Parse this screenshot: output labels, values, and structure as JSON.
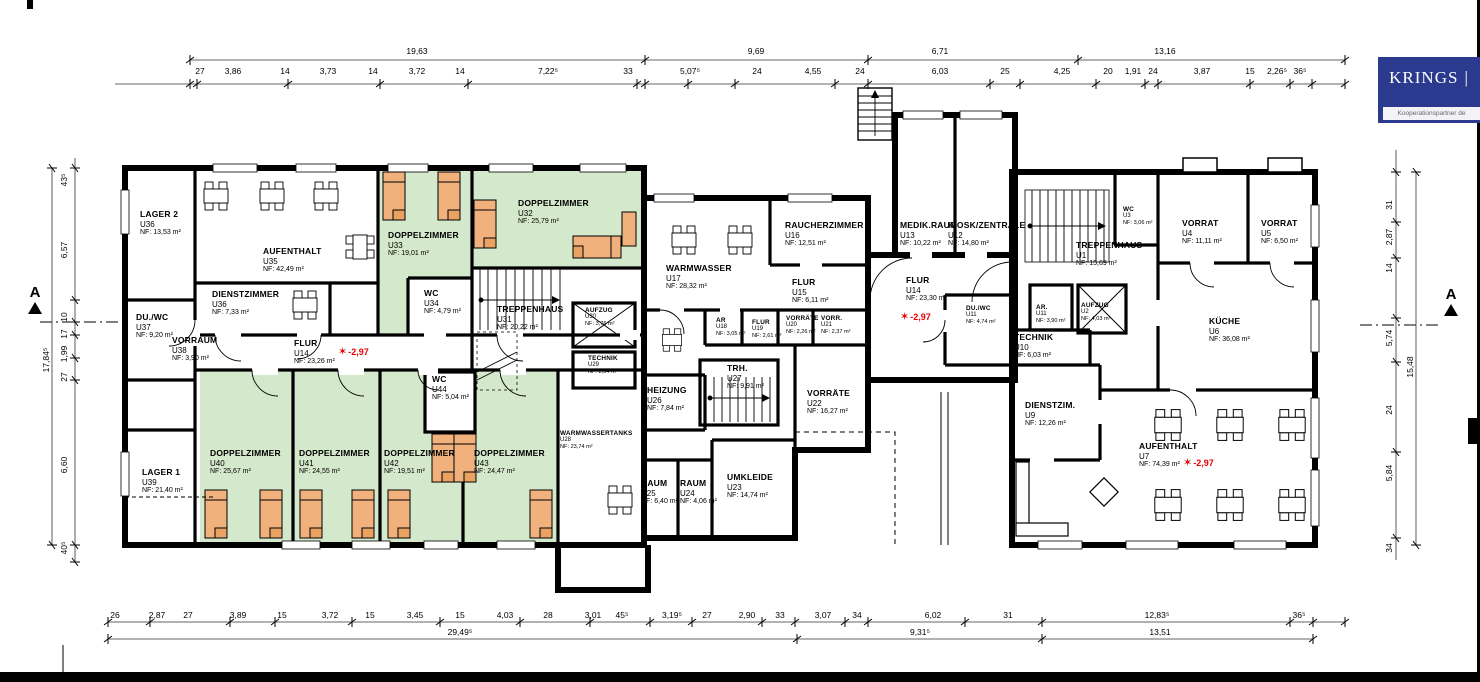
{
  "logo": {
    "brand": "KRINGS",
    "separator": "|",
    "subtitle": "Kooperationspartner de"
  },
  "section_marker": {
    "label": "A"
  },
  "icons": {
    "level_marker": "✶"
  },
  "levels": [
    "-2,97",
    "-2,97",
    "-2,97"
  ],
  "rooms": [
    {
      "name": "LAGER 2",
      "unit": "U36",
      "nf": "NF: 13,53 m²"
    },
    {
      "name": "AUFENTHALT",
      "unit": "U35",
      "nf": "NF:   42,49 m²"
    },
    {
      "name": "DIENSTZIMMER",
      "unit": "U36",
      "nf": "NF:   7,33 m²"
    },
    {
      "name": "DU./WC",
      "unit": "U37",
      "nf": "NF: 9,20 m²"
    },
    {
      "name": "VORRAUM",
      "unit": "U38",
      "nf": "NF:   3,90 m²"
    },
    {
      "name": "FLUR",
      "unit": "U14",
      "nf": "NF: 23,26 m²"
    },
    {
      "name": "DOPPELZIMMER",
      "unit": "U33",
      "nf": "NF:   19,01 m²"
    },
    {
      "name": "WC",
      "unit": "U34",
      "nf": "NF: 4,79 m²"
    },
    {
      "name": "DOPPELZIMMER",
      "unit": "U32",
      "nf": "NF:   25,79 m²"
    },
    {
      "name": "TREPPENHAUS",
      "unit": "U31",
      "nf": "NF:   20,22 m²"
    },
    {
      "name": "AUFZUG",
      "unit": "U30",
      "nf": "NF: 3,76 m²"
    },
    {
      "name": "TECHNIK",
      "unit": "U29",
      "nf": "NF: 2,34 m²"
    },
    {
      "name": "LAGER 1",
      "unit": "U39",
      "nf": "NF: 21,40 m²"
    },
    {
      "name": "DOPPELZIMMER",
      "unit": "U40",
      "nf": "NF:   25,67 m²"
    },
    {
      "name": "DOPPELZIMMER",
      "unit": "U41",
      "nf": "NF:   24,55 m²"
    },
    {
      "name": "DOPPELZIMMER",
      "unit": "U42",
      "nf": "NF:   19,51 m²"
    },
    {
      "name": "DOPPELZIMMER",
      "unit": "U43",
      "nf": "NF:   24,47 m²"
    },
    {
      "name": "WC",
      "unit": "U44",
      "nf": "NF: 5,04 m²"
    },
    {
      "name": "WARMWASSERTANKS",
      "unit": "U28",
      "nf": "NF:   23,74 m²"
    },
    {
      "name": "WARMWASSER",
      "unit": "U17",
      "nf": "NF:   28,32 m²"
    },
    {
      "name": "RAUCHERZIMMER",
      "unit": "U16",
      "nf": "NF:   12,51 m²"
    },
    {
      "name": "FLUR",
      "unit": "U15",
      "nf": "NF: 6,11 m²"
    },
    {
      "name": "AR",
      "unit": "U18",
      "nf": "NF: 3,05 m²"
    },
    {
      "name": "FLUR",
      "unit": "U19",
      "nf": "NF: 2,61 m²"
    },
    {
      "name": "VORRÄTE",
      "unit": "U20",
      "nf": "NF: 2,26 m²"
    },
    {
      "name": "VORR.",
      "unit": "U21",
      "nf": "NF: 2,37 m²"
    },
    {
      "name": "HEIZUNG",
      "unit": "U26",
      "nf": "NF: 7,84 m²"
    },
    {
      "name": "TRH.",
      "unit": "U27",
      "nf": "NF: 9,91 m²"
    },
    {
      "name": "RAUM",
      "unit": "U25",
      "nf": "NF: 6,40 m²"
    },
    {
      "name": "RAUM",
      "unit": "U24",
      "nf": "NF: 4,06 m²"
    },
    {
      "name": "UMKLEIDE",
      "unit": "U23",
      "nf": "NF:  14,74 m²"
    },
    {
      "name": "VORRÄTE",
      "unit": "U22",
      "nf": "NF: 16,27 m²"
    },
    {
      "name": "MEDIK.RAUM",
      "unit": "U13",
      "nf": "NF:  10,22 m²"
    },
    {
      "name": "KIOSK/ZENTRALE",
      "unit": "U12",
      "nf": "NF:   14,80 m²"
    },
    {
      "name": "FLUR",
      "unit": "U14",
      "nf": "NF: 23,30 m²"
    },
    {
      "name": "DU./WC",
      "unit": "U11",
      "nf": "NF: 4,74 m²"
    },
    {
      "name": "AR.",
      "unit": "U11",
      "nf": "NF: 3,90 m²"
    },
    {
      "name": "AUFZUG",
      "unit": "U2",
      "nf": "NF: 4,03 m²"
    },
    {
      "name": "TECHNIK",
      "unit": "U10",
      "nf": "NF:  6,03 m²"
    },
    {
      "name": "TREPPENHAUS",
      "unit": "U1",
      "nf": "NF:   15,69 m²"
    },
    {
      "name": "WC",
      "unit": "U3",
      "nf": "NF: 3,06 m²"
    },
    {
      "name": "DIENSTZIM.",
      "unit": "U9",
      "nf": "NF:   12,26 m²"
    },
    {
      "name": "VORRAT",
      "unit": "U4",
      "nf": "NF: 11,11 m²"
    },
    {
      "name": "VORRAT",
      "unit": "U5",
      "nf": "NF: 6,50 m²"
    },
    {
      "name": "KÜCHE",
      "unit": "U6",
      "nf": "NF: 36,08 m²"
    },
    {
      "name": "AUFENTHALT",
      "unit": "U7",
      "nf": "NF:   74,39 m²"
    }
  ],
  "dims": {
    "top_totals": [
      "19,63",
      "9,69",
      "6,71",
      "13,16"
    ],
    "top_segments": [
      "27",
      "3,86",
      "14",
      "3,73",
      "14",
      "3,72",
      "14",
      "7,22⁵",
      "33",
      "5,07⁵",
      "24",
      "4,55",
      "24",
      "6,03",
      "25",
      "4,25",
      "20",
      "1,91",
      "24",
      "3,87",
      "15",
      "2,26⁵",
      "36⁵"
    ],
    "bottom_segments": [
      "26",
      "2,87",
      "27",
      "3,89",
      "15",
      "3,72",
      "15",
      "3,45",
      "15",
      "4,03",
      "28",
      "3,01",
      "45⁵",
      "3,19⁵",
      "27",
      "2,90",
      "33",
      "3,07",
      "34",
      "6,02",
      "31",
      "12,83⁵",
      "36⁵"
    ],
    "bottom_totals": [
      "29,49⁵",
      "9,31⁵",
      "13,51"
    ],
    "left_segments": [
      "43⁵",
      "6,57",
      "10",
      "17",
      "1,99",
      "27",
      "6,60",
      "40⁵"
    ],
    "left_total": "17,84⁵",
    "right_segments": [
      "31",
      "2,87",
      "14",
      "5,74",
      "24",
      "5,84",
      "34"
    ],
    "right_total": "15,48"
  }
}
